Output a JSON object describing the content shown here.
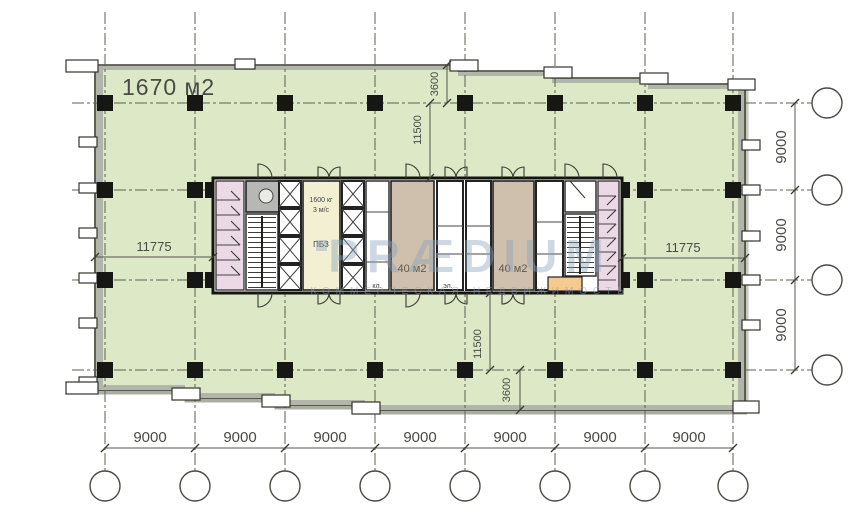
{
  "plan": {
    "area_label": "1670 м2",
    "watermark": {
      "line1": "PRÆDIUM",
      "line2": "КОММЕРЧЕСКАЯ НЕДВИЖИМОСТЬ"
    },
    "rooms": {
      "room1_label": "40 м2",
      "room2_label": "40 м2",
      "lift_capacity": "1600 кг",
      "lift_speed": "3 м/с",
      "safe_zone": "ПБЗ",
      "closet": "кл.",
      "electrical": "эл."
    },
    "dims": {
      "bottom": [
        "9000",
        "9000",
        "9000",
        "9000",
        "9000",
        "9000",
        "9000"
      ],
      "right": [
        "9000",
        "9000",
        "9000"
      ],
      "top_offset": "3600",
      "top_core": "11500",
      "bottom_core": "11500",
      "bottom_offset": "3600",
      "left_wing": "11775",
      "right_wing": "11775"
    },
    "colors": {
      "floor": "#dde8c6",
      "room_tan": "#cfc0ad",
      "wc_pink": "#ecd9e6",
      "lobby_yellow": "#f3efd2",
      "service_orange": "#f6c98f",
      "wallband": "#b2b6aa",
      "dim_text": "#4a4a46",
      "watermark": "#8aa3bd"
    }
  }
}
